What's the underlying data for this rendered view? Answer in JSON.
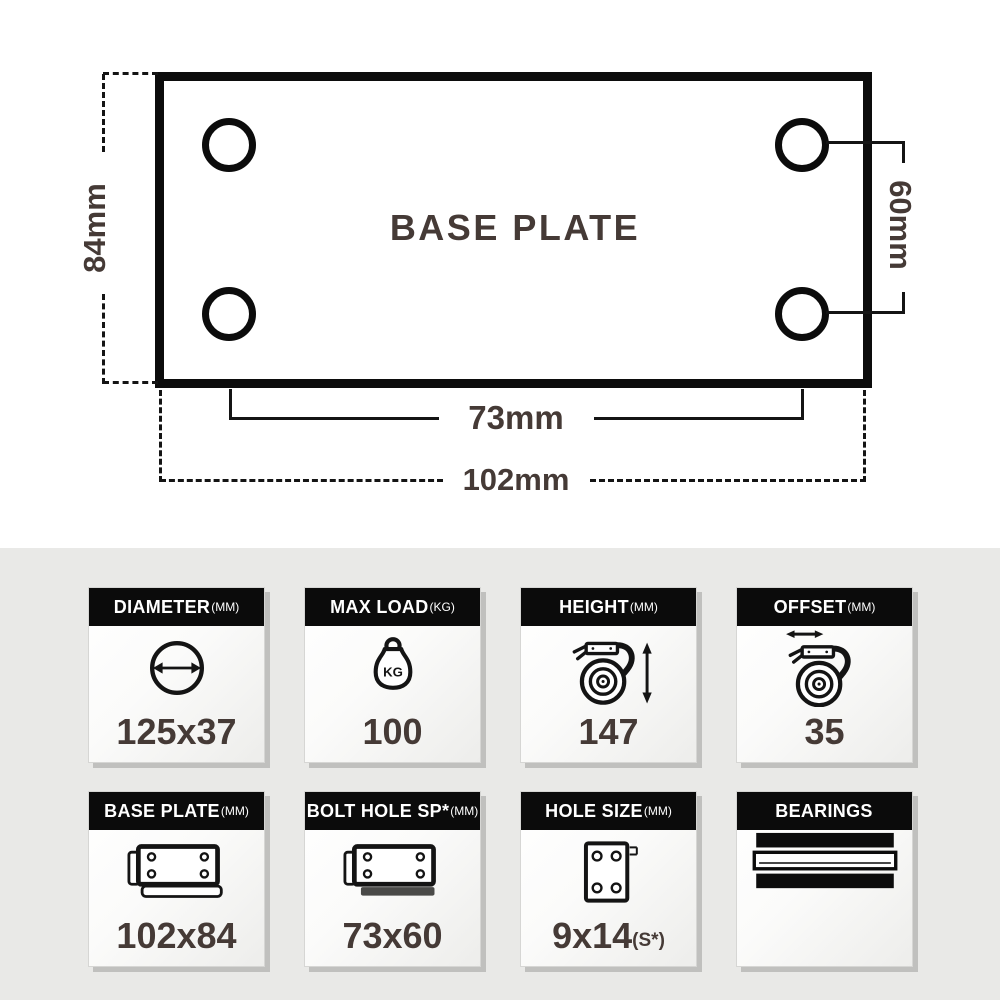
{
  "drawing": {
    "title": "BASE PLATE",
    "dim_height_label": "84mm",
    "dim_hole_vertical_label": "60mm",
    "dim_hole_horizontal_label": "73mm",
    "dim_width_label": "102mm"
  },
  "cards": [
    {
      "label": "DIAMETER",
      "unit": "(MM)",
      "icon": "diameter-icon",
      "value": "125x37"
    },
    {
      "label": "MAX LOAD",
      "unit": "(KG)",
      "icon": "max-load-weight-icon",
      "icon_label": "KG",
      "value": "100"
    },
    {
      "label": "HEIGHT",
      "unit": "(MM)",
      "icon": "caster-height-icon",
      "value": "147"
    },
    {
      "label": "OFFSET",
      "unit": "(MM)",
      "icon": "caster-offset-icon",
      "value": "35"
    },
    {
      "label": "BASE PLATE",
      "unit": "(MM)",
      "icon": "base-plate-icon",
      "value": "102x84"
    },
    {
      "label": "BOLT HOLE SP*",
      "unit": "(MM)",
      "icon": "bolt-hole-spacing-icon",
      "value": "73x60"
    },
    {
      "label": "HOLE SIZE",
      "unit": "(MM)",
      "icon": "hole-size-icon",
      "value": "9x14",
      "value_suffix": "(S*)"
    },
    {
      "label": "BEARINGS",
      "unit": "",
      "icon": "bearings-icon",
      "value": ""
    }
  ],
  "colors": {
    "text_dark": "#453A36",
    "line_black": "#141414",
    "header_bg": "#0B0B0B",
    "header_text": "#FFFFFF",
    "section_bg": "#E9E9E7",
    "card_shadow": "#C0C0BE"
  }
}
